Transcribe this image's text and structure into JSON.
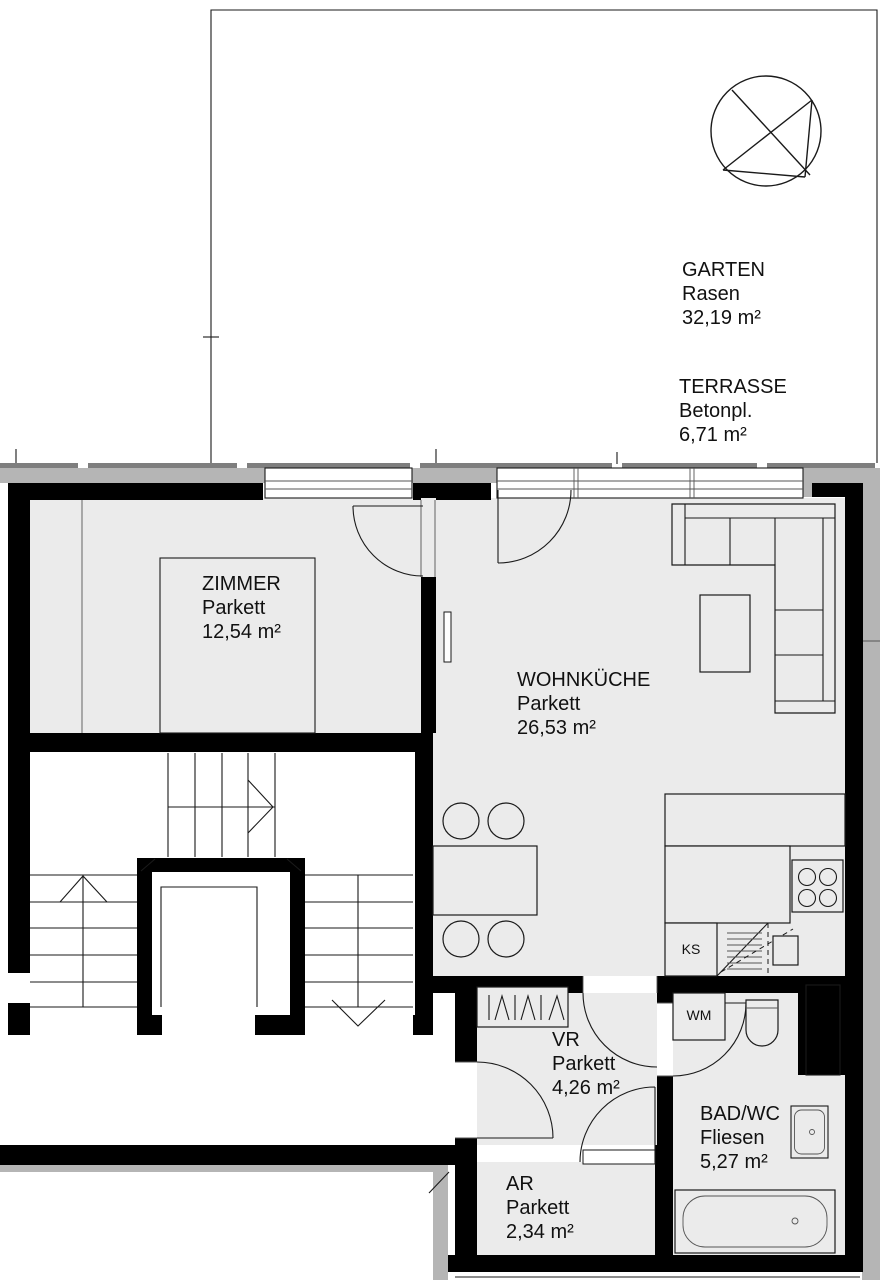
{
  "areas": {
    "garten": {
      "name": "GARTEN",
      "surface": "Rasen",
      "size": "32,19 m²"
    },
    "terrasse": {
      "name": "TERRASSE",
      "surface": "Betonpl.",
      "size": "6,71 m²"
    },
    "zimmer": {
      "name": "ZIMMER",
      "surface": "Parkett",
      "size": "12,54 m²"
    },
    "wohnkueche": {
      "name": "WOHNKÜCHE",
      "surface": "Parkett",
      "size": "26,53 m²"
    },
    "vr": {
      "name": "VR",
      "surface": "Parkett",
      "size": "4,26 m²"
    },
    "ar": {
      "name": "AR",
      "surface": "Parkett",
      "size": "2,34 m²"
    },
    "badwc": {
      "name": "BAD/WC",
      "surface": "Fliesen",
      "size": "5,27 m²"
    }
  },
  "appliances": {
    "fridge_label": "KS",
    "washing_machine_label": "WM"
  },
  "colors": {
    "wall": "#000000",
    "floor": "#ebebeb",
    "exterior_band": "#b5b5b5",
    "edge_strip": "#7e7e7e",
    "line": "#1a1a1a",
    "background": "#ffffff"
  }
}
